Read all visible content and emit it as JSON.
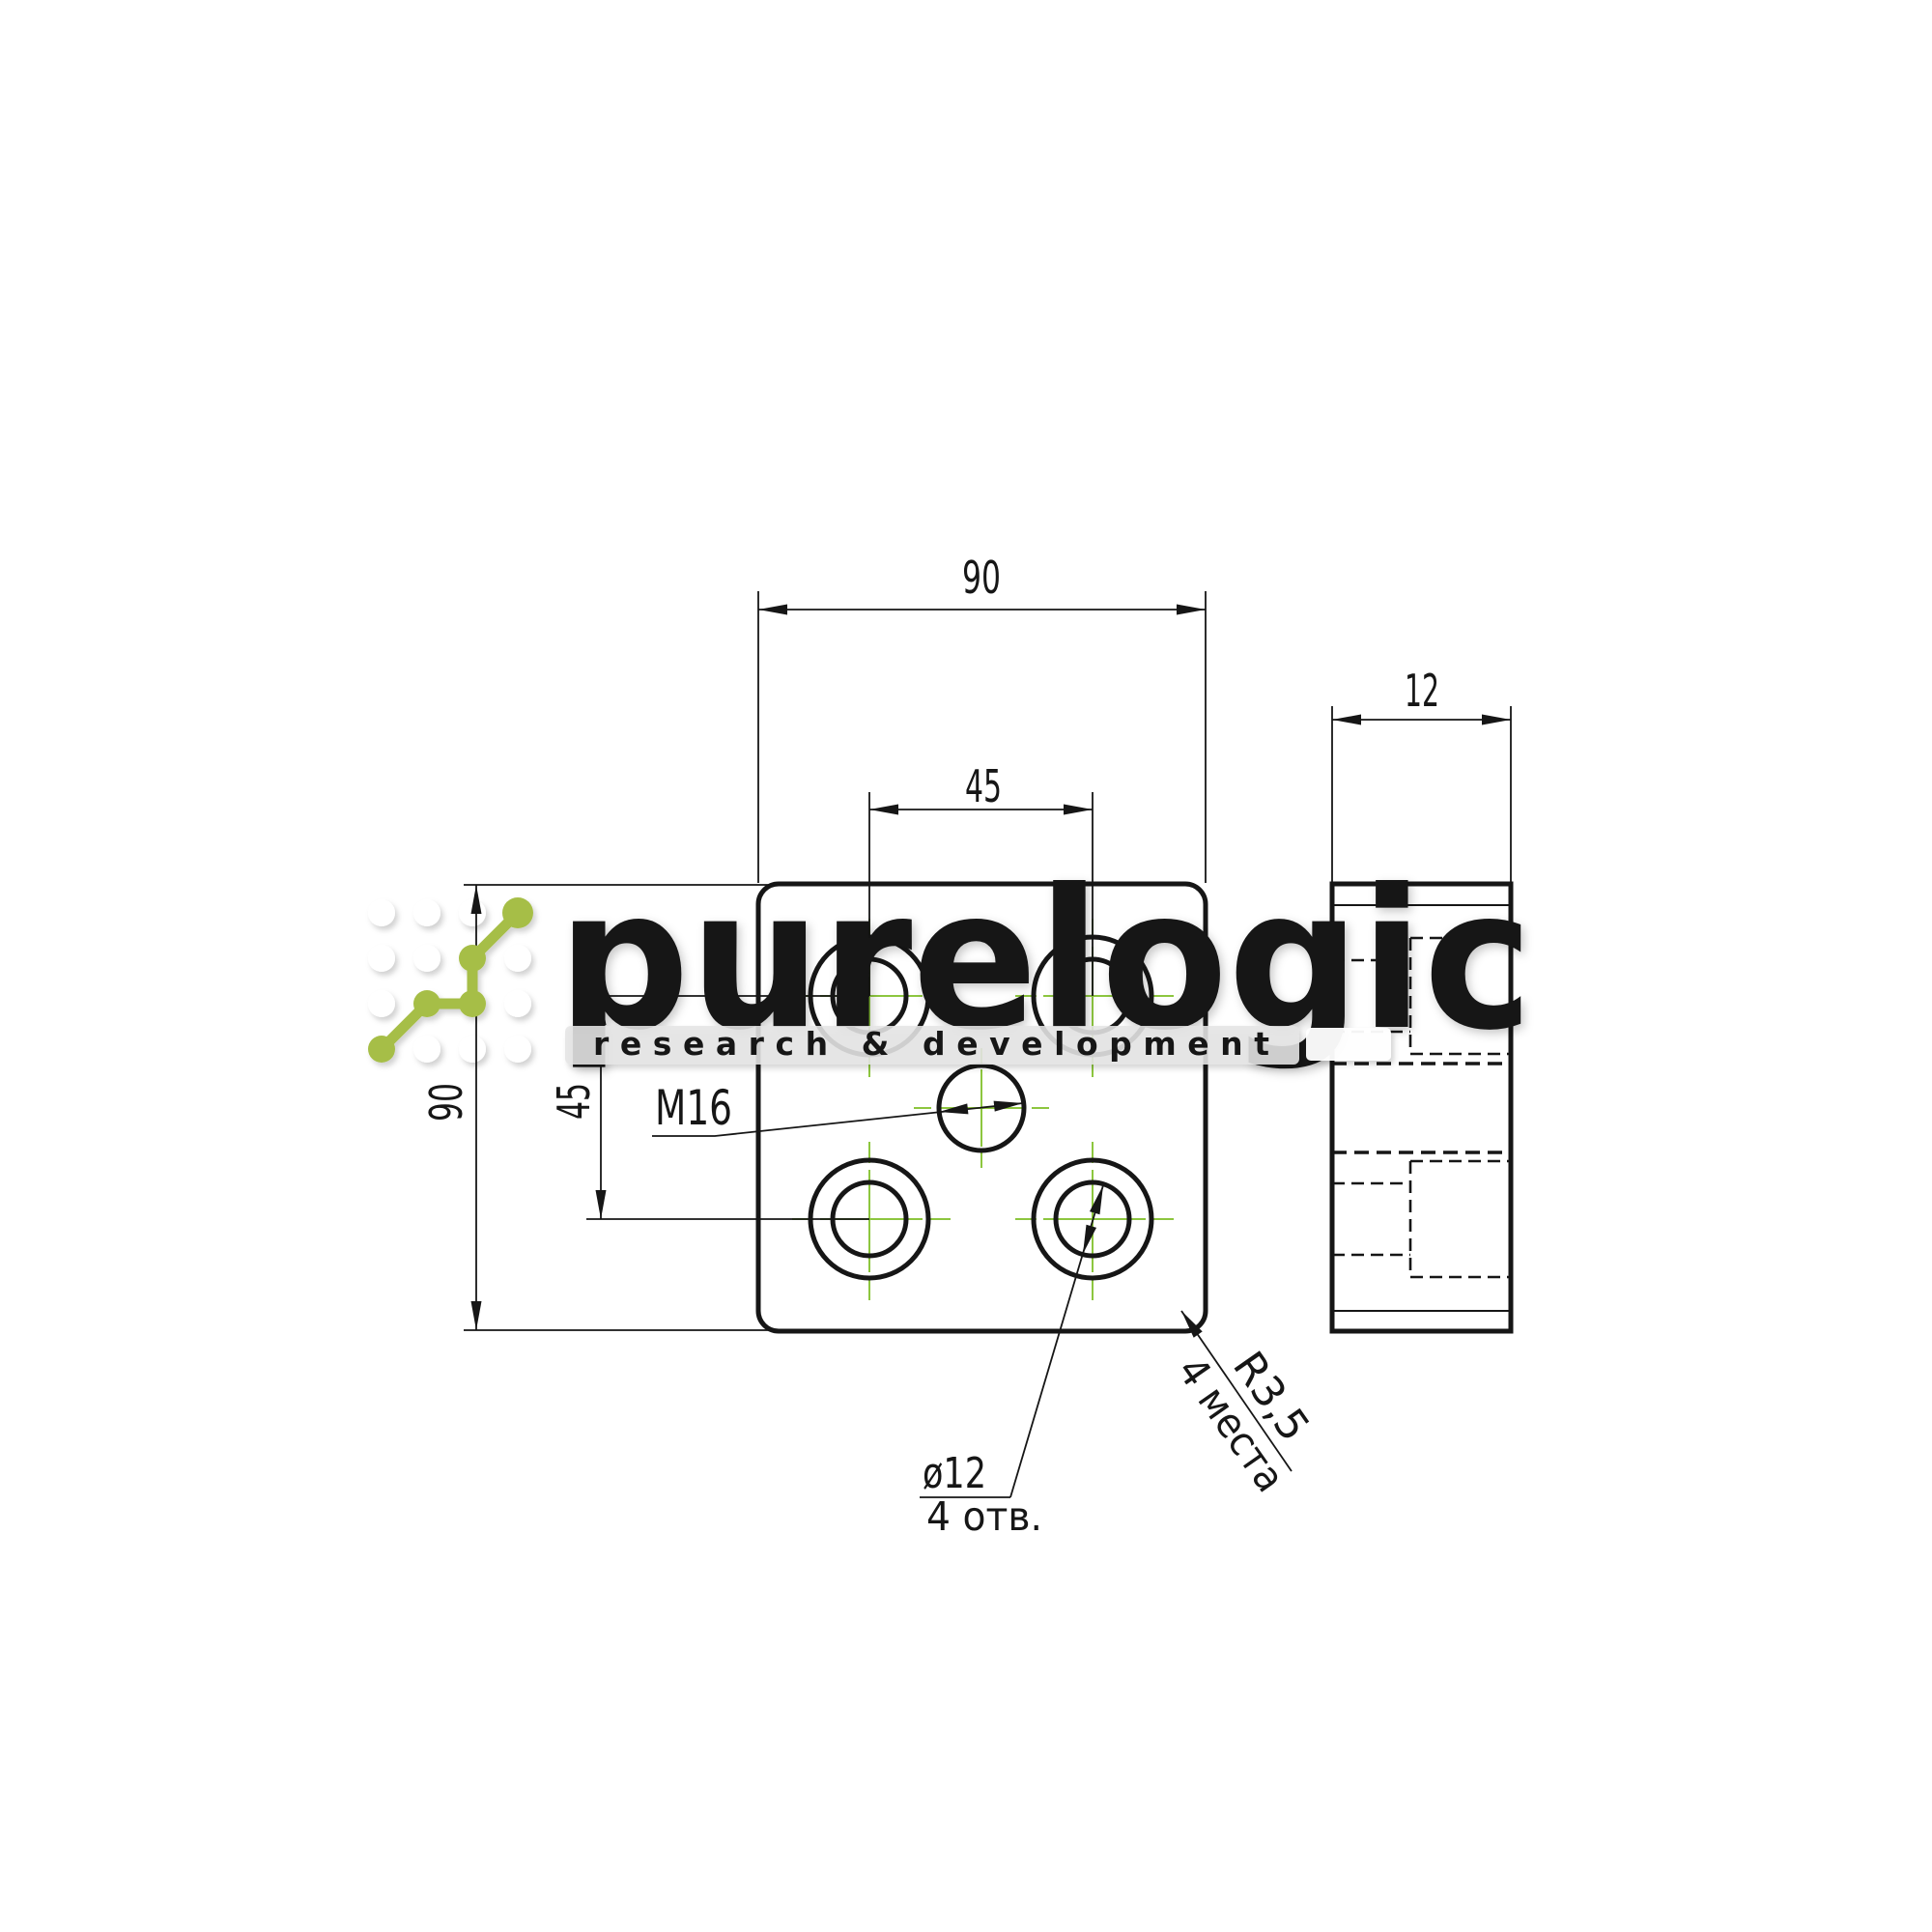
{
  "drawing": {
    "dimensions": {
      "plate_width": "90",
      "hole_spacing_horizontal": "45",
      "plate_height": "90",
      "hole_spacing_vertical": "45",
      "thickness": "12"
    },
    "labels": {
      "thread": "M16",
      "hole_diameter": "ø12",
      "hole_count": "4 отв.",
      "corner_radius": "R3,5",
      "corner_radius_places": "4 места"
    }
  },
  "watermark": {
    "brand": "purelogic",
    "tagline": "research & development"
  },
  "colors": {
    "line": "#161616",
    "centerline_green": "#8dc63f",
    "logo_green": "#a6be47"
  }
}
